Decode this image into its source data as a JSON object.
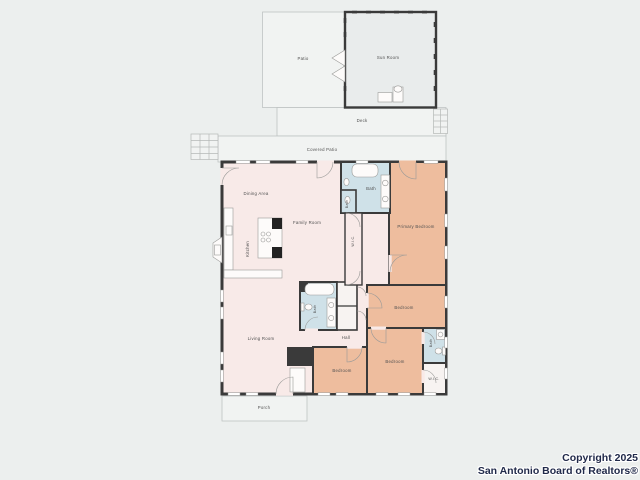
{
  "page": {
    "background": "#ecefee"
  },
  "floorplan": {
    "colors": {
      "wall": "#3a3a3a",
      "living_area": "#f8eae8",
      "bedroom": "#eebd9e",
      "bathroom": "#cfe1e8",
      "outdoor": "#f1f3f2",
      "closet": "#f7f3f1",
      "sunroom_floor": "#e9ecec"
    },
    "labels": {
      "patio": "Patio",
      "sun_room": "Sun Room",
      "deck": "Deck",
      "covered_patio": "Covered Patio",
      "dining_area": "Dining Area",
      "family_room": "Family Room",
      "kitchen": "Kitchen",
      "primary_bath": "Bath",
      "powder_bath": "Bath",
      "primary_wic": "W.I.C.",
      "primary_bedroom": "Primary Bedroom",
      "living_room": "Living Room",
      "hall_bath": "Bath",
      "hall": "Hall",
      "bedroom_ne": "Bedroom",
      "bedroom_s": "Bedroom",
      "bedroom_se": "Bedroom",
      "se_bath": "Bath",
      "se_wic": "W.I.C.",
      "porch": "Porch"
    }
  },
  "watermark": {
    "line1": "Copyright 2025",
    "line2": "San Antonio Board of Realtors®"
  }
}
